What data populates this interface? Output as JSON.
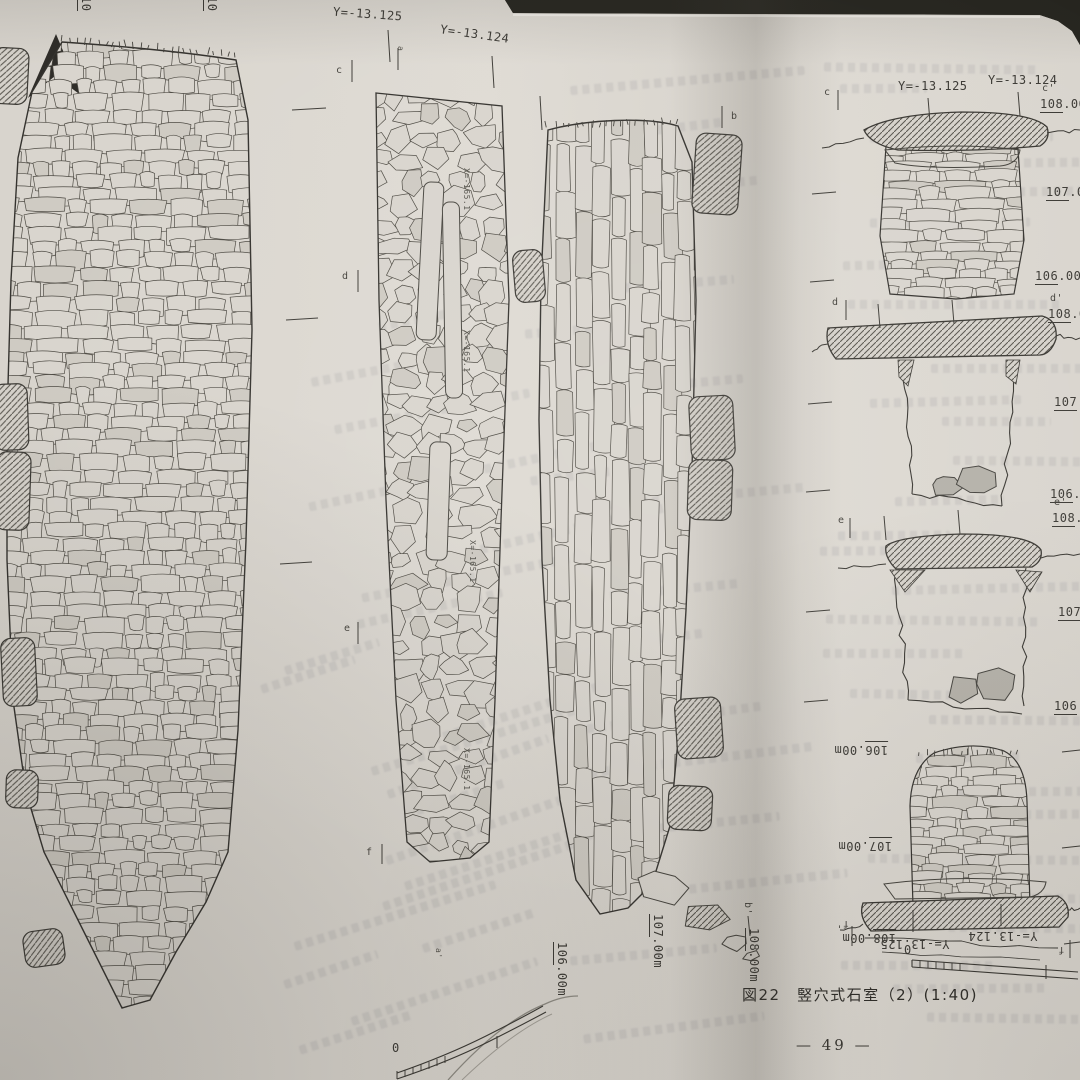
{
  "icons": {
    "north_arrow": "▲"
  },
  "colors": {
    "paper": "#dcd8d1",
    "ink": "#3c3a35",
    "background": "#26251f",
    "stone_gray": "#b4b1a9"
  },
  "left_page": {
    "cut_elev_labels": [
      {
        "u": "10",
        "r": ""
      },
      {
        "u": "10",
        "r": ""
      }
    ],
    "coord_labels": {
      "y1": "Y=-13.125",
      "y2": "Y=-13.124"
    },
    "section_markers": {
      "a": "a",
      "a_prime": "a'",
      "b": "b",
      "b_prime": "b'",
      "c": "c",
      "d": "d",
      "e": "e",
      "f": "f"
    },
    "x_coord_labels": [
      "X=-165.1",
      "X=-165.1",
      "X=-165.1",
      "X=-165.1"
    ],
    "bottom_elev_labels": [
      {
        "u": "106",
        "r": ".00m"
      },
      {
        "u": "107",
        "r": ".00m"
      },
      {
        "u": "108",
        "r": ".00m"
      }
    ],
    "scale_zero": "0"
  },
  "right_page": {
    "section_c": {
      "left_marker": "c",
      "right_marker": "c'",
      "coord_labels": [
        "Y=-13.125",
        "Y=-13.124"
      ],
      "elev": [
        {
          "u": "108",
          "r": ".00m"
        },
        {
          "u": "107",
          "r": ".00"
        },
        {
          "u": "106",
          "r": ".00"
        }
      ]
    },
    "section_d": {
      "left_marker": "d",
      "right_marker": "d'",
      "elev": [
        {
          "u": "108",
          "r": ".00"
        },
        {
          "u": "107",
          "r": ".0"
        },
        {
          "u": "106",
          "r": ".0"
        }
      ]
    },
    "section_e": {
      "left_marker": "e",
      "right_marker": "e'",
      "elev": [
        {
          "u": "108",
          "r": "."
        },
        {
          "u": "107",
          "r": "."
        },
        {
          "u": "106",
          "r": "."
        }
      ]
    },
    "section_f": {
      "left_marker": "f",
      "right_marker": "f'",
      "coord_labels": [
        "Y=-13.125",
        "Y=-13.124"
      ],
      "elev": [
        {
          "u": "106",
          "r": ".00m"
        },
        {
          "u": "107",
          "r": ".00m"
        },
        {
          "u": "108",
          "r": ".00m"
        }
      ]
    },
    "scale_zero": "0",
    "caption": "図22　竪穴式石室（2）(1:40)",
    "page_number": "— 49 —"
  }
}
